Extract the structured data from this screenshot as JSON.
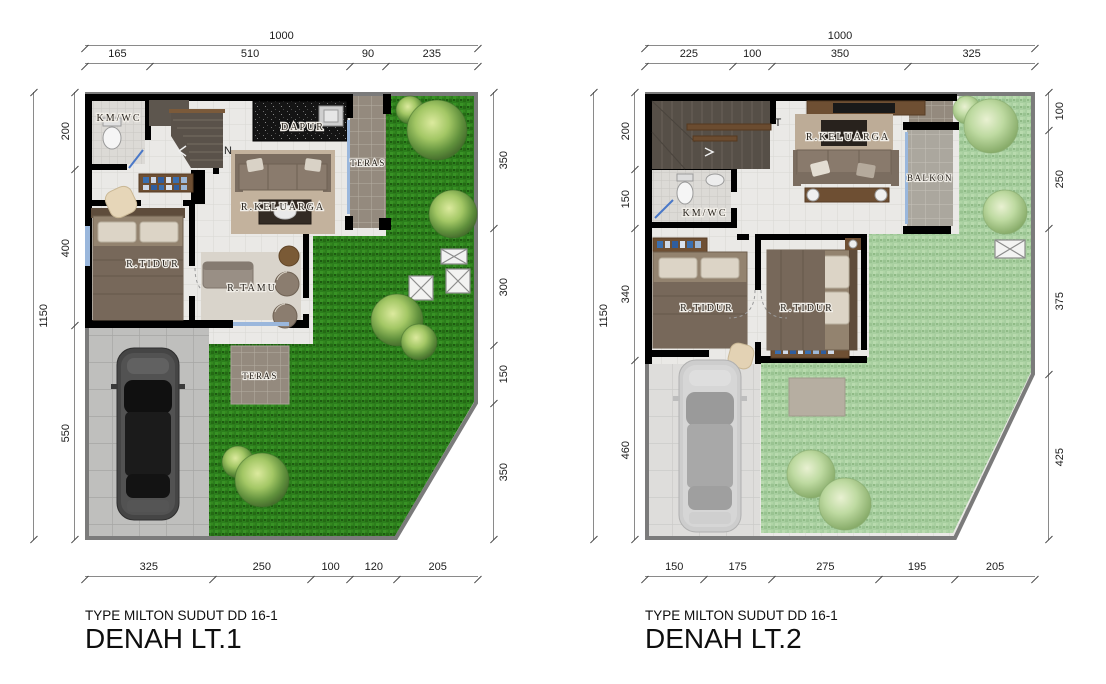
{
  "sheet": {
    "background": "#ffffff"
  },
  "colors": {
    "wall": "#000000",
    "plot_border": "#7b7b7b",
    "grass_dark": "#2c7e1c",
    "grass_light": "#a8cfa0",
    "floor_tile": "#eae9e6",
    "driveway": "#bfbfbd",
    "dim_line": "#8a8a8a",
    "dim_text": "#1c1c1c",
    "glass": "#9ab7dc",
    "wood": "#6e4f33"
  },
  "plans": [
    {
      "subtitle": "TYPE MILTON SUDUT DD 16-1",
      "title": "DENAH LT.1",
      "compass_label": "N",
      "rooms": {
        "kmwc": "KM/WC",
        "dapur": "DAPUR",
        "teras_side": "TERAS",
        "keluarga": "R.KELUARGA",
        "tidur": "R.TIDUR",
        "tamu": "R.TAMU",
        "teras_front": "TERAS"
      },
      "dims": {
        "top_total": "1000",
        "left_total": "1150",
        "top": [
          {
            "label": "165",
            "value": 165
          },
          {
            "label": "510",
            "value": 510
          },
          {
            "label": "90",
            "value": 90
          },
          {
            "label": "235",
            "value": 235
          }
        ],
        "left": [
          {
            "label": "200",
            "value": 200
          },
          {
            "label": "400",
            "value": 400
          },
          {
            "label": "550",
            "value": 550
          }
        ],
        "right": [
          {
            "label": "350",
            "value": 350
          },
          {
            "label": "300",
            "value": 300
          },
          {
            "label": "150",
            "value": 150
          },
          {
            "label": "350",
            "value": 350
          }
        ],
        "bottom": [
          {
            "label": "325",
            "value": 325
          },
          {
            "label": "250",
            "value": 250
          },
          {
            "label": "100",
            "value": 100
          },
          {
            "label": "120",
            "value": 120
          },
          {
            "label": "205",
            "value": 205
          }
        ]
      }
    },
    {
      "subtitle": "TYPE MILTON SUDUT DD 16-1",
      "title": "DENAH LT.2",
      "compass_label": "T",
      "rooms": {
        "kmwc": "KM/WC",
        "keluarga": "R.KELUARGA",
        "balkon": "BALKON",
        "tidur1": "R.TIDUR",
        "tidur2": "R.TIDUR"
      },
      "dims": {
        "top_total": "1000",
        "left_total": "1150",
        "top": [
          {
            "label": "225",
            "value": 225
          },
          {
            "label": "100",
            "value": 100
          },
          {
            "label": "350",
            "value": 350
          },
          {
            "label": "325",
            "value": 325
          }
        ],
        "left": [
          {
            "label": "200",
            "value": 200
          },
          {
            "label": "150",
            "value": 150
          },
          {
            "label": "340",
            "value": 340
          },
          {
            "label": "460",
            "value": 460
          }
        ],
        "right": [
          {
            "label": "100",
            "value": 100
          },
          {
            "label": "250",
            "value": 250
          },
          {
            "label": "375",
            "value": 375
          },
          {
            "label": "425",
            "value": 425
          }
        ],
        "bottom": [
          {
            "label": "150",
            "value": 150
          },
          {
            "label": "175",
            "value": 175
          },
          {
            "label": "275",
            "value": 275
          },
          {
            "label": "195",
            "value": 195
          },
          {
            "label": "205",
            "value": 205
          }
        ]
      }
    }
  ]
}
